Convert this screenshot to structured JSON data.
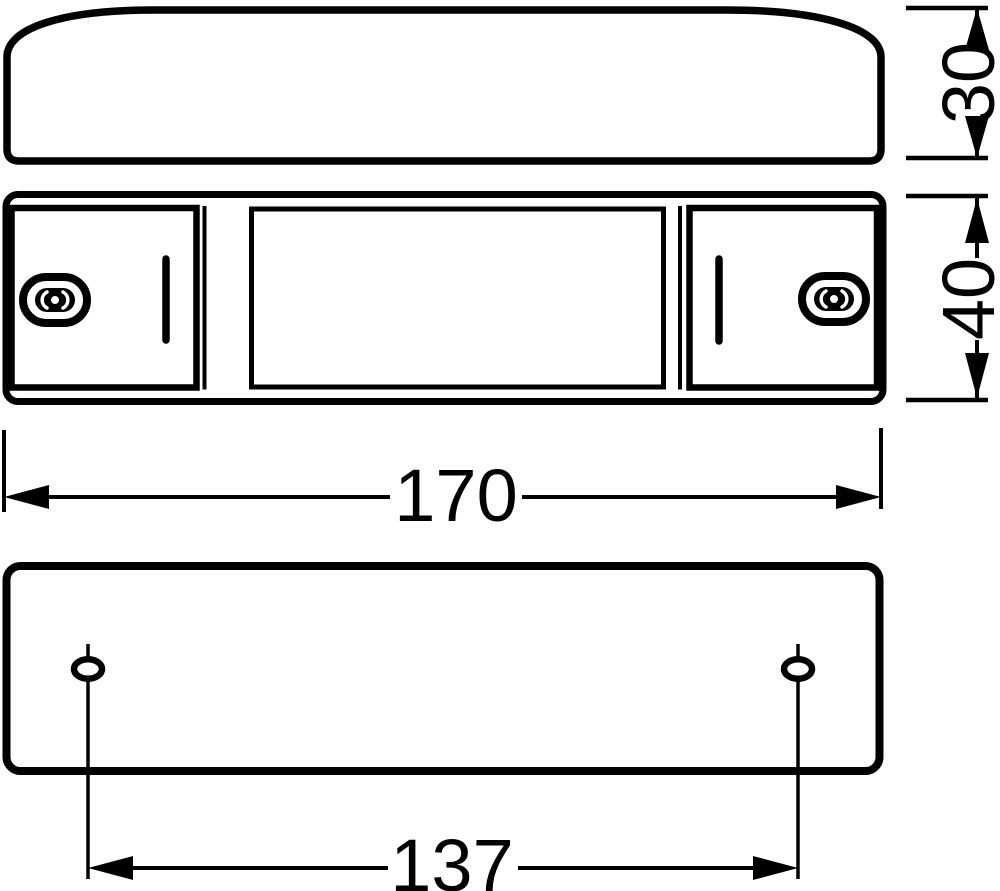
{
  "drawing": {
    "colors": {
      "line": "#000000",
      "background": "#ffffff"
    },
    "dimensions": {
      "profile_height": "30",
      "body_height": "40",
      "body_width": "170",
      "hole_spacing": "137"
    }
  }
}
